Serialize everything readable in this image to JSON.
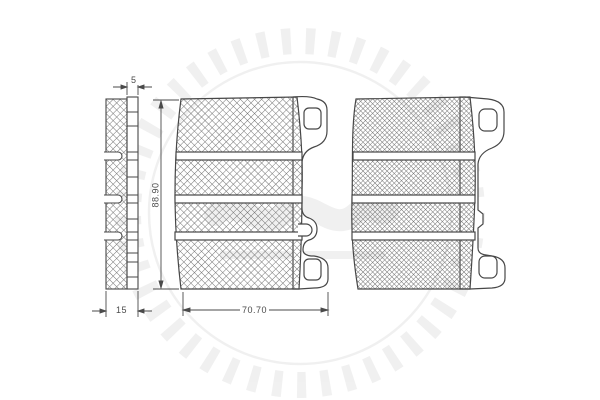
{
  "dimensions": {
    "backplate_thickness_mm": "5",
    "pad_total_thickness_mm": "15",
    "pad_height_mm": "88.90",
    "pad_width_mm": "70.70"
  },
  "icons": {
    "watermark": "optimal-sun-logo-watermark"
  },
  "colors": {
    "line": "#474747",
    "hatch": "#757575",
    "background": "#ffffff",
    "dimension_text": "#4a4a4a",
    "watermark_gray": "#ebebeb"
  }
}
